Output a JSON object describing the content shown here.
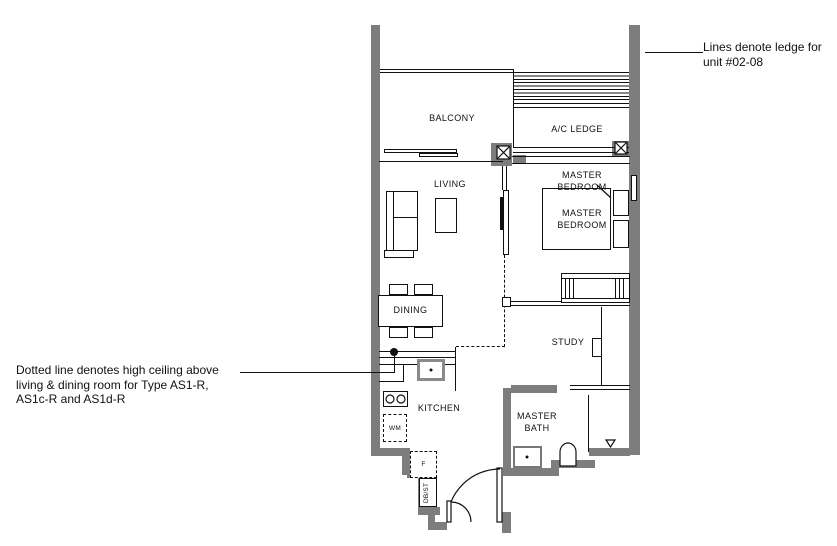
{
  "plan": {
    "rooms": {
      "balcony": "BALCONY",
      "ac_ledge": "A/C LEDGE",
      "living": "LIVING",
      "master_bedroom_callout": "MASTER\nBEDROOM",
      "master_bedroom": "MASTER\nBEDROOM",
      "dining": "DINING",
      "study": "STUDY",
      "kitchen": "KITCHEN",
      "master_bath": "MASTER\nBATH"
    },
    "fixtures": {
      "washing_machine": "WM",
      "fridge": "F",
      "db_store": "DB/ST"
    }
  },
  "annotations": {
    "ledge_note": "Lines denote ledge for\nunit #02-08",
    "ceiling_note": "Dotted line denotes high ceiling above\nliving & dining room for Type AS1-R,\nAS1c-R and AS1d-R"
  },
  "colors": {
    "wall": "#7d7d7d",
    "line": "#111111",
    "background": "#ffffff"
  }
}
